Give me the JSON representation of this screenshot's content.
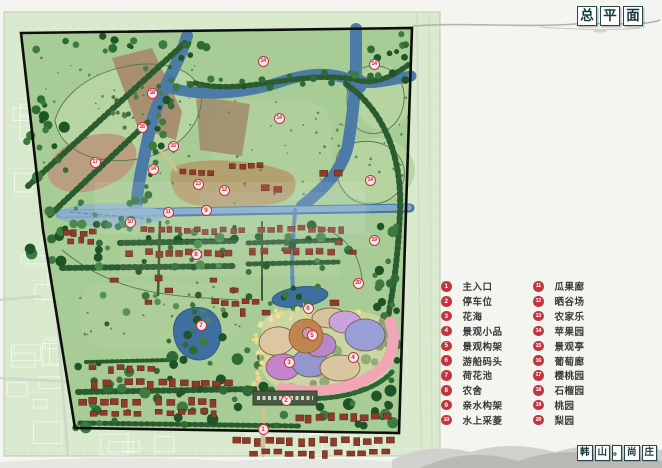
{
  "header": {
    "title": "总平面"
  },
  "footer": {
    "label": "韩山。尚庄"
  },
  "colors": {
    "accent_red": "#c13540",
    "site_green": "#a8cc95",
    "river_blue": "#4d7ba7",
    "orchard_brown": "#a78f70",
    "house_red": "#8e3b28",
    "title_ink": "#16383c"
  },
  "legend": {
    "columns": [
      {
        "items": [
          {
            "num": "1",
            "label": "主入口"
          },
          {
            "num": "2",
            "label": "停车位"
          },
          {
            "num": "3",
            "label": "花海"
          },
          {
            "num": "4",
            "label": "景观小品"
          },
          {
            "num": "5",
            "label": "景观构架"
          },
          {
            "num": "6",
            "label": "游船码头"
          },
          {
            "num": "7",
            "label": "荷花池"
          },
          {
            "num": "8",
            "label": "农舍"
          },
          {
            "num": "9",
            "label": "亲水构架"
          },
          {
            "num": "10",
            "label": "水上采菱"
          }
        ]
      },
      {
        "items": [
          {
            "num": "11",
            "label": "瓜果廊"
          },
          {
            "num": "12",
            "label": "晒谷场"
          },
          {
            "num": "13",
            "label": "农家乐"
          },
          {
            "num": "14",
            "label": "苹果园"
          },
          {
            "num": "15",
            "label": "景观亭"
          },
          {
            "num": "16",
            "label": "葡萄廊"
          },
          {
            "num": "17",
            "label": "樱桃园"
          },
          {
            "num": "18",
            "label": "石榴园"
          },
          {
            "num": "19",
            "label": "桃园"
          },
          {
            "num": "20",
            "label": "梨园"
          }
        ]
      }
    ]
  },
  "map": {
    "markers": [
      {
        "num": "1",
        "x": 263,
        "y": 429
      },
      {
        "num": "2",
        "x": 286,
        "y": 400
      },
      {
        "num": "3",
        "x": 289,
        "y": 362
      },
      {
        "num": "4",
        "x": 353,
        "y": 357
      },
      {
        "num": "5",
        "x": 312,
        "y": 335
      },
      {
        "num": "6",
        "x": 308,
        "y": 308
      },
      {
        "num": "7",
        "x": 201,
        "y": 325
      },
      {
        "num": "8",
        "x": 196,
        "y": 254
      },
      {
        "num": "9",
        "x": 206,
        "y": 210
      },
      {
        "num": "10",
        "x": 130,
        "y": 222
      },
      {
        "num": "11",
        "x": 168,
        "y": 212
      },
      {
        "num": "12",
        "x": 224,
        "y": 190
      },
      {
        "num": "13",
        "x": 198,
        "y": 184
      },
      {
        "num": "14",
        "x": 153,
        "y": 169
      },
      {
        "num": "14",
        "x": 263,
        "y": 61
      },
      {
        "num": "14",
        "x": 374,
        "y": 64
      },
      {
        "num": "14",
        "x": 279,
        "y": 118
      },
      {
        "num": "14",
        "x": 370,
        "y": 180
      },
      {
        "num": "15",
        "x": 173,
        "y": 146
      },
      {
        "num": "16",
        "x": 142,
        "y": 127
      },
      {
        "num": "17",
        "x": 95,
        "y": 162
      },
      {
        "num": "18",
        "x": 152,
        "y": 93
      },
      {
        "num": "19",
        "x": 374,
        "y": 240
      },
      {
        "num": "20",
        "x": 358,
        "y": 283
      }
    ]
  }
}
